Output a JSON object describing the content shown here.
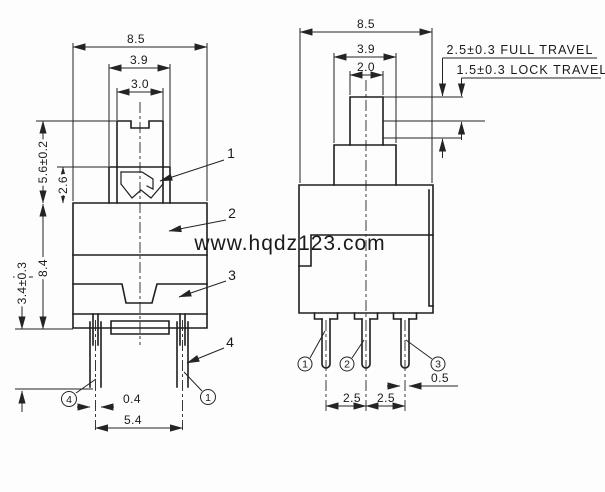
{
  "watermark": "www.hqdz123.com",
  "front_view": {
    "dim_width": "8.5",
    "dim_cap_width": "3.9",
    "dim_stem_width": "3.0",
    "dim_stem_height": "5.6±0.2",
    "dim_flange_height": "2.6",
    "dim_body_height": "8.4",
    "dim_lower_height": "3.4±0.3",
    "dim_pin_width": "0.4",
    "dim_pin_span": "5.4",
    "callout_1": "1",
    "callout_2": "2",
    "callout_3": "3",
    "callout_4": "4",
    "pin_circle_left": "4",
    "pin_circle_right": "1"
  },
  "side_view": {
    "dim_width": "8.5",
    "dim_cap_width": "3.9",
    "dim_stem_width": "2.0",
    "note_full_travel": "2.5±0.3 FULL TRAVEL",
    "note_lock_travel": "1.5±0.3 LOCK TRAVEL",
    "dim_pin_pitch_left": "2.5",
    "dim_pin_pitch_right": "2.5",
    "dim_pin_width": "0.5",
    "pin_circle_1": "1",
    "pin_circle_2": "2",
    "pin_circle_3": "3"
  },
  "colors": {
    "line": "#1f1f1f",
    "dimension": "#242424",
    "watermark": "#cbcbcb",
    "background": "#fdfdfd"
  }
}
